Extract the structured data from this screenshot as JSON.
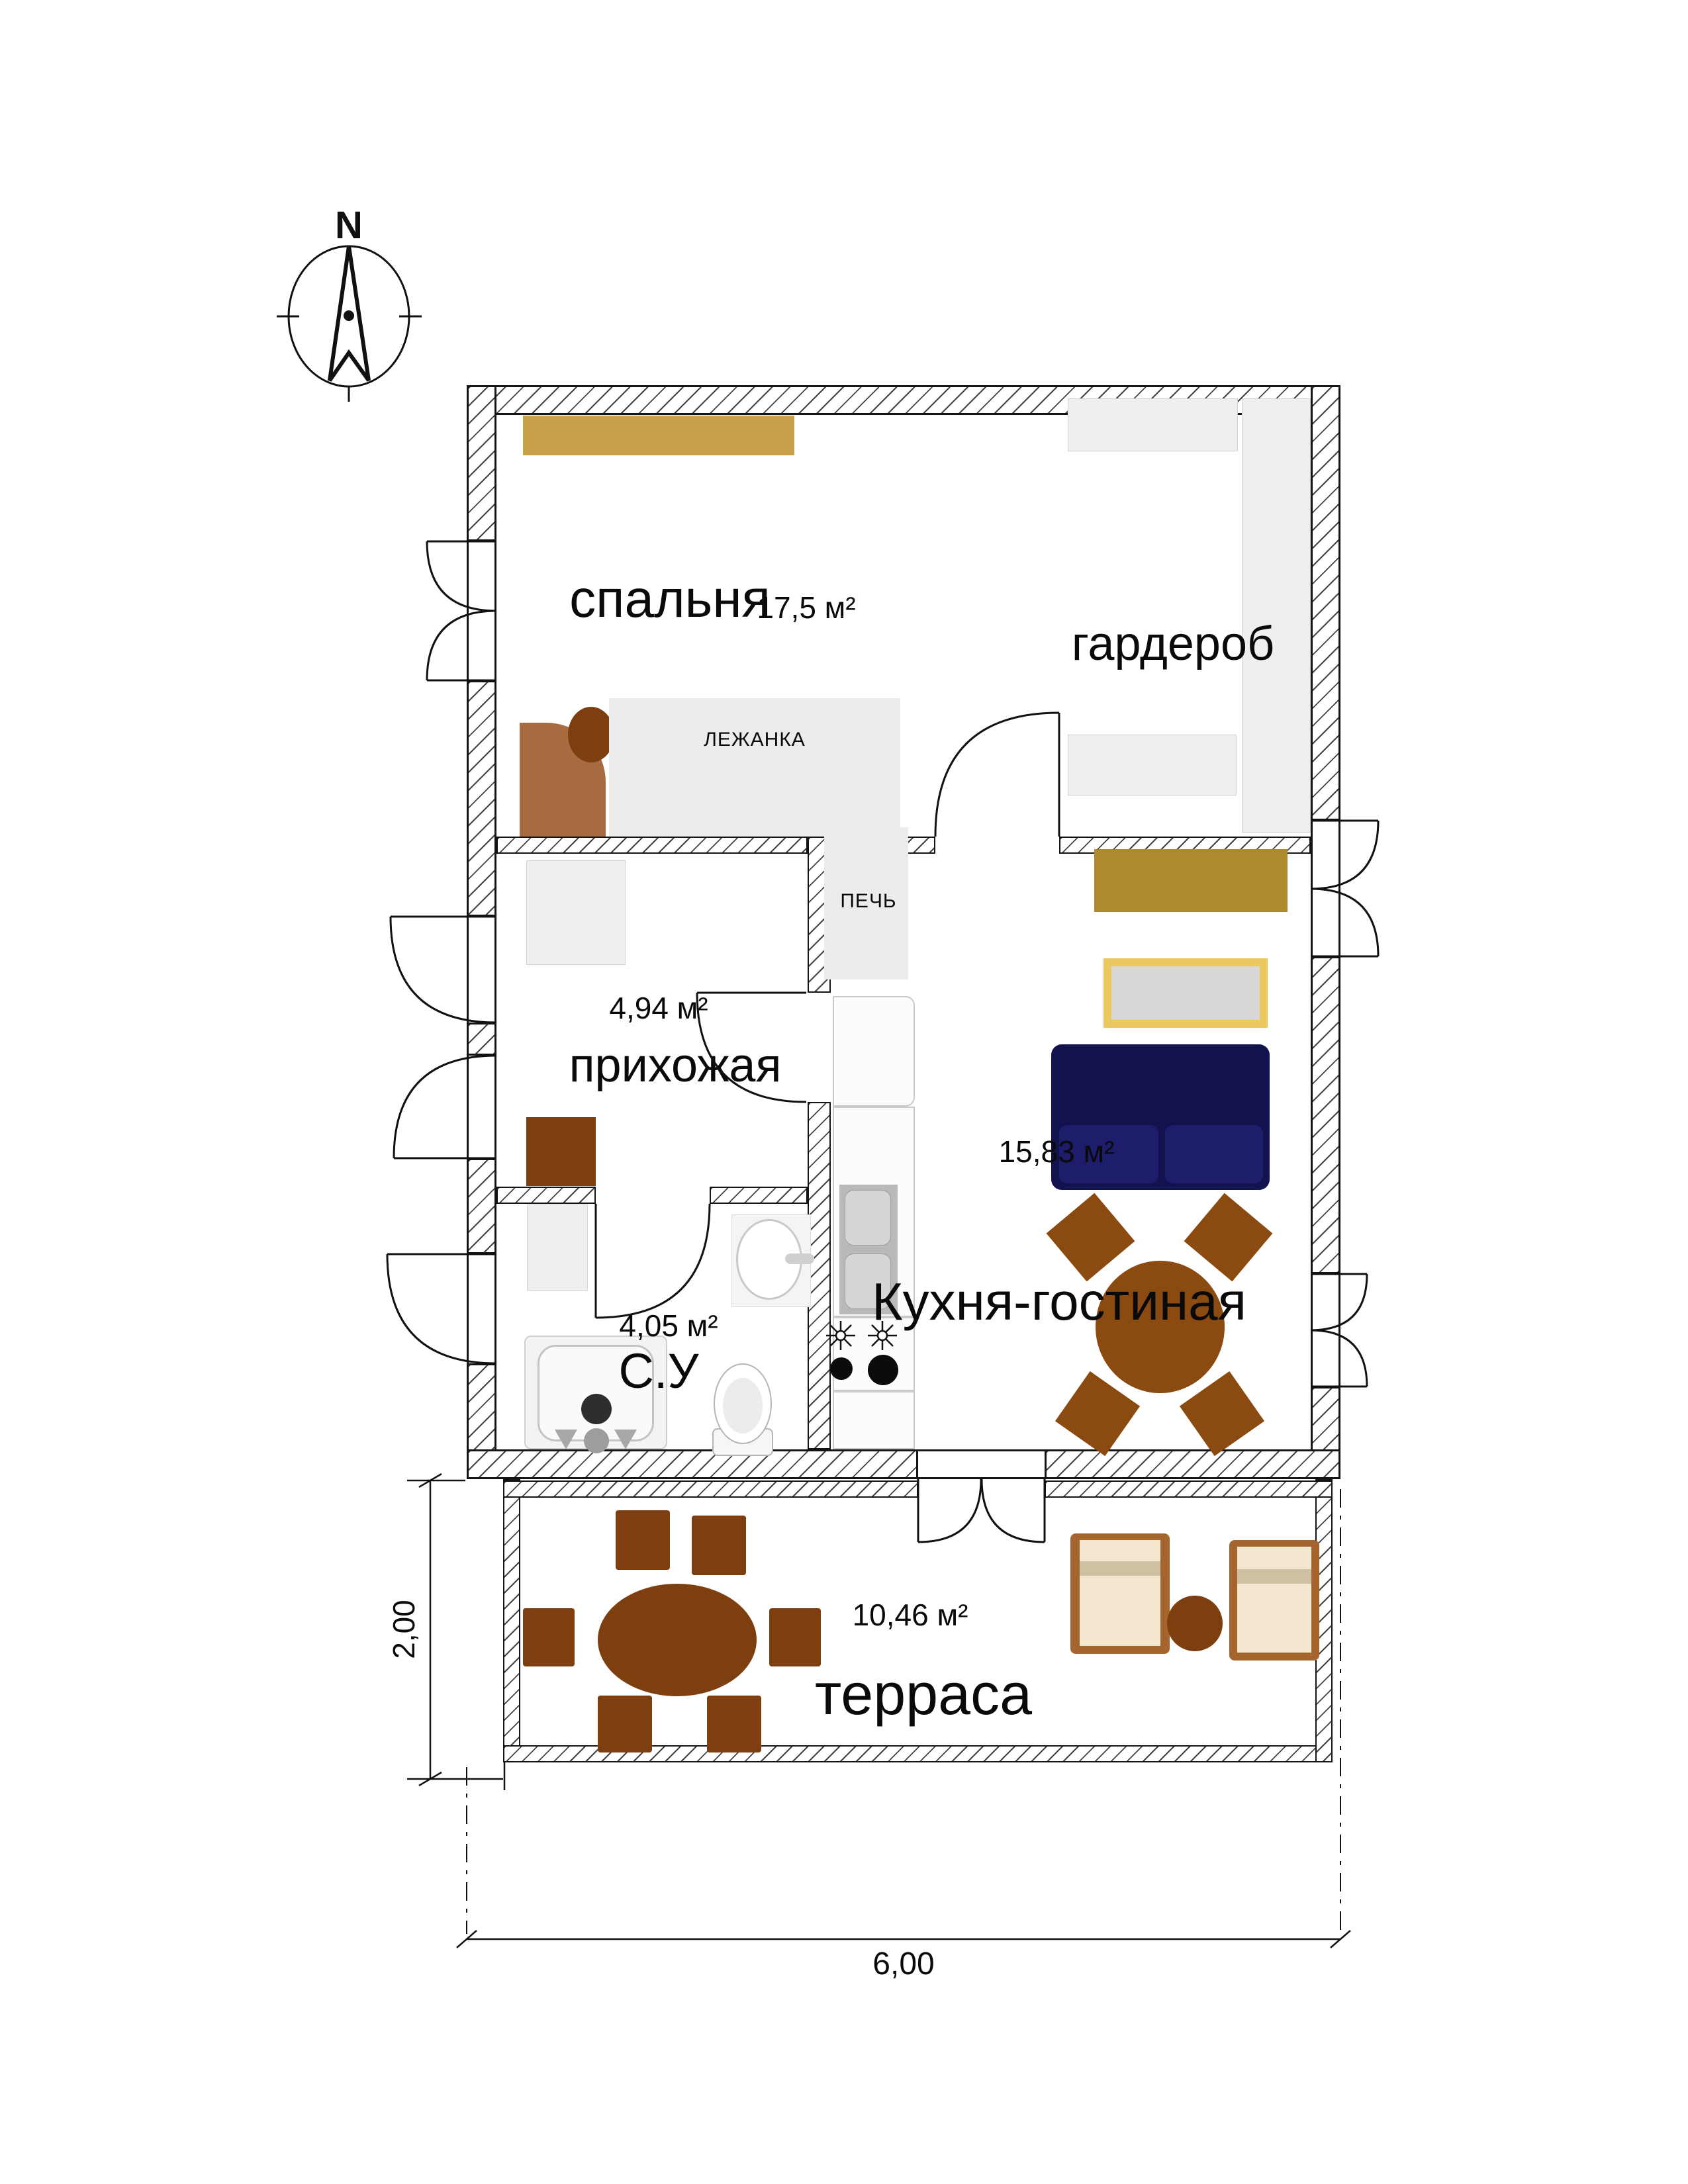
{
  "plan": {
    "compass": {
      "north_label": "N"
    },
    "rooms": {
      "bedroom": {
        "name": "спальня",
        "area": "17,5 м²"
      },
      "wardrobe": {
        "name": "гардероб",
        "area": ""
      },
      "hallway": {
        "name": "прихожая",
        "area": "4,94 м²"
      },
      "bathroom": {
        "name": "С.У",
        "area": "4,05 м²"
      },
      "kitchen_living": {
        "name": "Кухня-гостиная",
        "area": "15,83 м²"
      },
      "terrace": {
        "name": "терраса",
        "area": "10,46 м²"
      }
    },
    "fixtures": {
      "stove_bed_label": "ЛЕЖАНКА",
      "stove_label": "ПЕЧЬ"
    },
    "dimensions": {
      "terrace_depth": "2,00",
      "house_width": "6,00"
    },
    "colors": {
      "shelf_gold": "#c8a24b",
      "cabinet_gold": "#ad8a2e",
      "sofa_navy": "#12124e",
      "sofa_cushion": "#1d1d6b",
      "wood": "#8a4a10",
      "wood_dark": "#7d3f10",
      "wood_light": "#a76b3f",
      "tv_frame": "#ecc95f",
      "tv_screen": "#d8d8d8",
      "lounge_frame": "#a4652f",
      "lounge_cushion": "#f3e8cf",
      "lounge_band": "#cfc0a4",
      "platform_gray": "#ececec",
      "closet_gray": "#eeeeee"
    }
  }
}
